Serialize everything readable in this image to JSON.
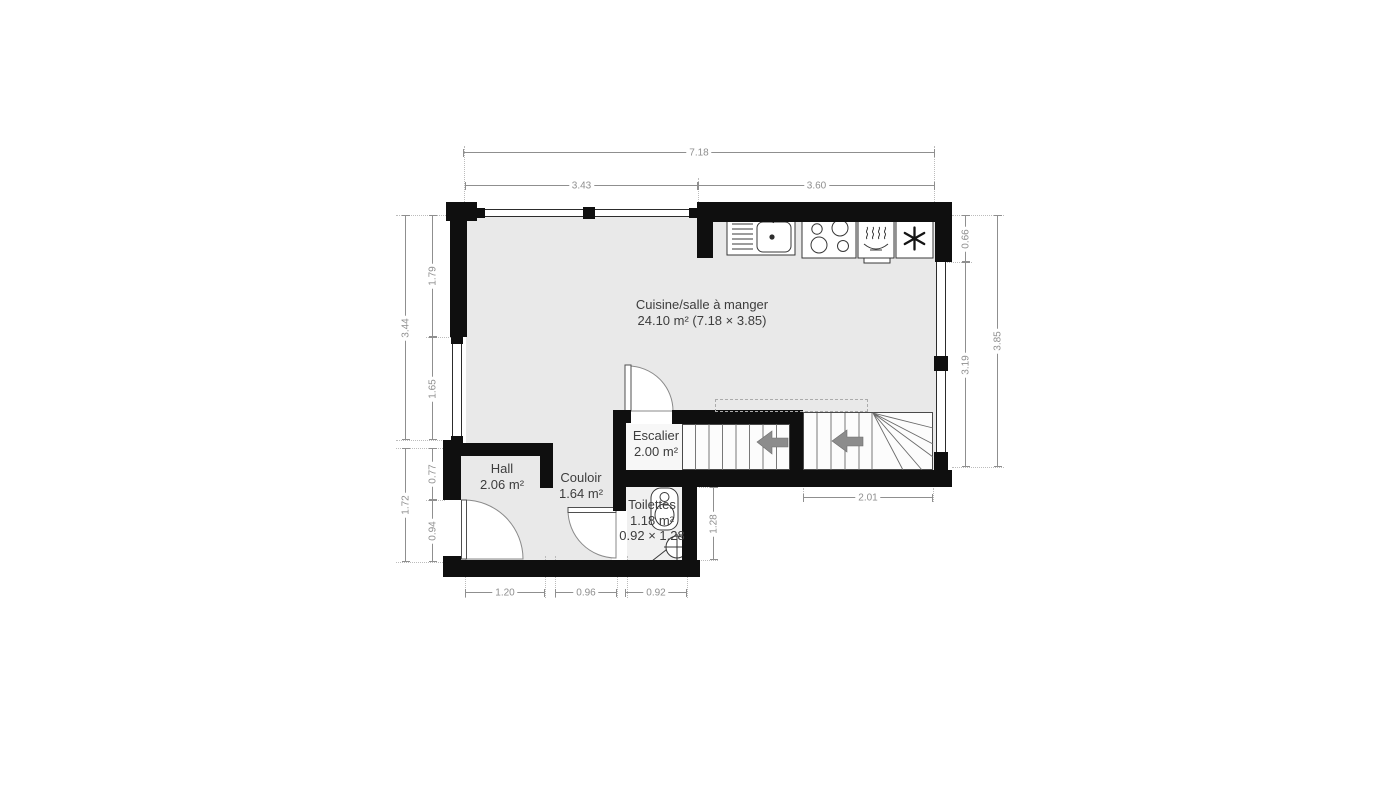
{
  "rooms": {
    "kitchen": {
      "name": "Cuisine/salle à manger",
      "area": "24.10 m² (7.18 × 3.85)"
    },
    "escalier": {
      "name": "Escalier",
      "area": "2.00 m²"
    },
    "hall": {
      "name": "Hall",
      "area": "2.06 m²"
    },
    "couloir": {
      "name": "Couloir",
      "area": "1.64 m²"
    },
    "toilettes": {
      "name": "Toilettes",
      "area": "1.18 m²",
      "size": "0.92 × 1.28"
    }
  },
  "dimensions": {
    "total_width": "7.18",
    "kitchen_left": "3.43",
    "kitchen_right": "3.60",
    "left_total": "3.44",
    "left_upper": "1.79",
    "left_lower": "1.65",
    "hall_total": "1.72",
    "hall_upper": "0.77",
    "hall_door": "0.94",
    "right_top": "0.66",
    "right_window": "3.19",
    "right_total": "3.85",
    "stairs_width": "2.01",
    "toilettes_depth": "1.28",
    "hall_width": "1.20",
    "couloir_width": "0.96",
    "toilettes_width": "0.92"
  },
  "icons": {
    "sink": "kitchen-sink",
    "stove": "cooktop-four-burners",
    "dishwasher": "dishwasher-steam-dish",
    "fridge": "snowflake",
    "toilet": "toilet-top-view",
    "washbasin": "corner-washbasin",
    "stair_arrows": "arrow-left"
  },
  "colors": {
    "wall": "#0f0f0f",
    "floor": "#e9e9e9",
    "floor_light": "#f7f7f7",
    "dimension": "#8f8f8f",
    "label": "#3d3d3d",
    "arrow": "#8c8c8c"
  }
}
